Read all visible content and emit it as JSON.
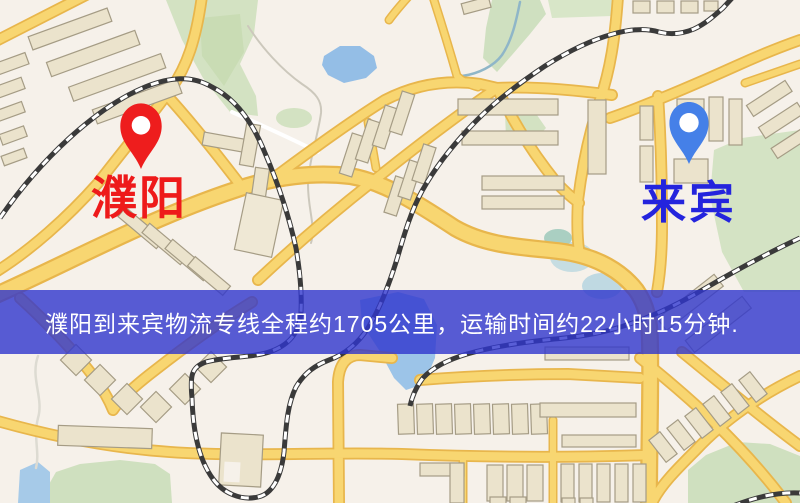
{
  "map": {
    "origin": {
      "name": "濮阳",
      "marker_color": "#ee1d1d",
      "label_color": "#ee1a1a",
      "marker_icon": "red-location-pin"
    },
    "destination": {
      "name": "来宾",
      "marker_color": "#4580e8",
      "label_color": "#2424dd",
      "marker_icon": "blue-location-pin"
    },
    "banner": {
      "text": "濮阳到来宾物流专线全程约1705公里，运输时间约22小时15分钟.",
      "background_color": "#3036c9",
      "text_color": "#ffffff"
    },
    "route": {
      "distance": "约1705公里",
      "duration": "约22小时15分钟"
    }
  }
}
